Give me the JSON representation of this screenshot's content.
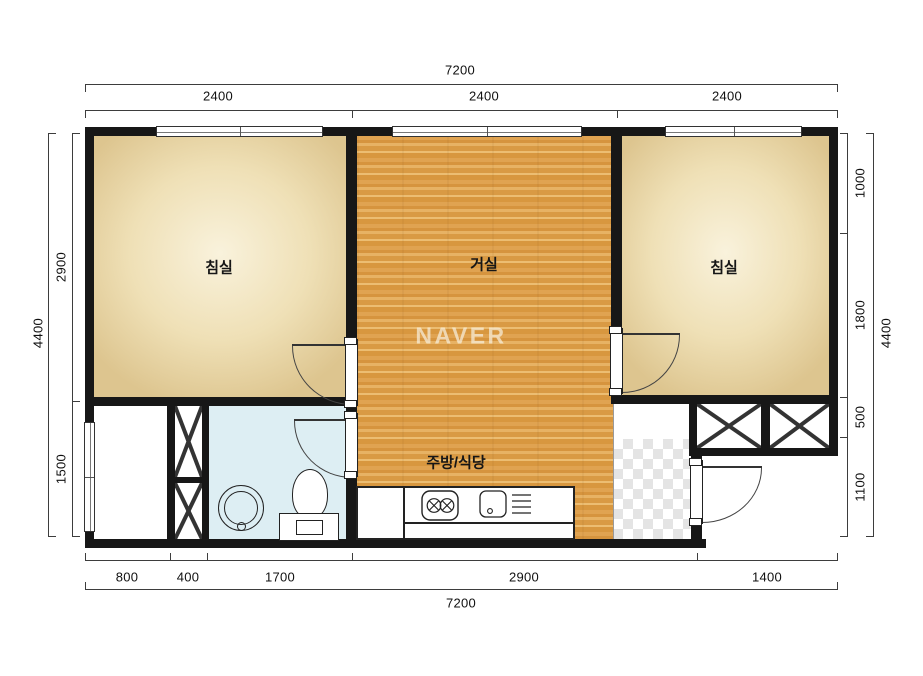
{
  "plan": {
    "watermark": "NAVER",
    "rooms": {
      "bedroom_left": "침실",
      "living_room": "거실",
      "bedroom_right": "침실",
      "kitchen_dining": "주방/식당"
    },
    "dimensions": {
      "top": {
        "total": "7200",
        "segments": [
          "2400",
          "2400",
          "2400"
        ]
      },
      "bottom": {
        "total": "7200",
        "segments": [
          "800",
          "400",
          "1700",
          "2900",
          "1400"
        ]
      },
      "left": {
        "total": "4400",
        "segments": [
          "2900",
          "1500"
        ]
      },
      "right": {
        "total": "4400",
        "segments": [
          "1000",
          "1800",
          "500",
          "1100"
        ]
      }
    },
    "colors": {
      "wall": "#171717",
      "bedroom_floor": "#efe0b6",
      "living_floor": "#dc9d47",
      "bathroom_floor": "#ddeef3",
      "entry_tile": "#e4e4e4",
      "dimension_text": "#101010",
      "watermark_text": "#f6eedd"
    },
    "icons": [
      "window-icon",
      "door-swing-icon",
      "closet-x-icon",
      "washbasin-icon",
      "toilet-icon",
      "stove-icon",
      "sink-icon",
      "dish-rack-icon"
    ]
  }
}
